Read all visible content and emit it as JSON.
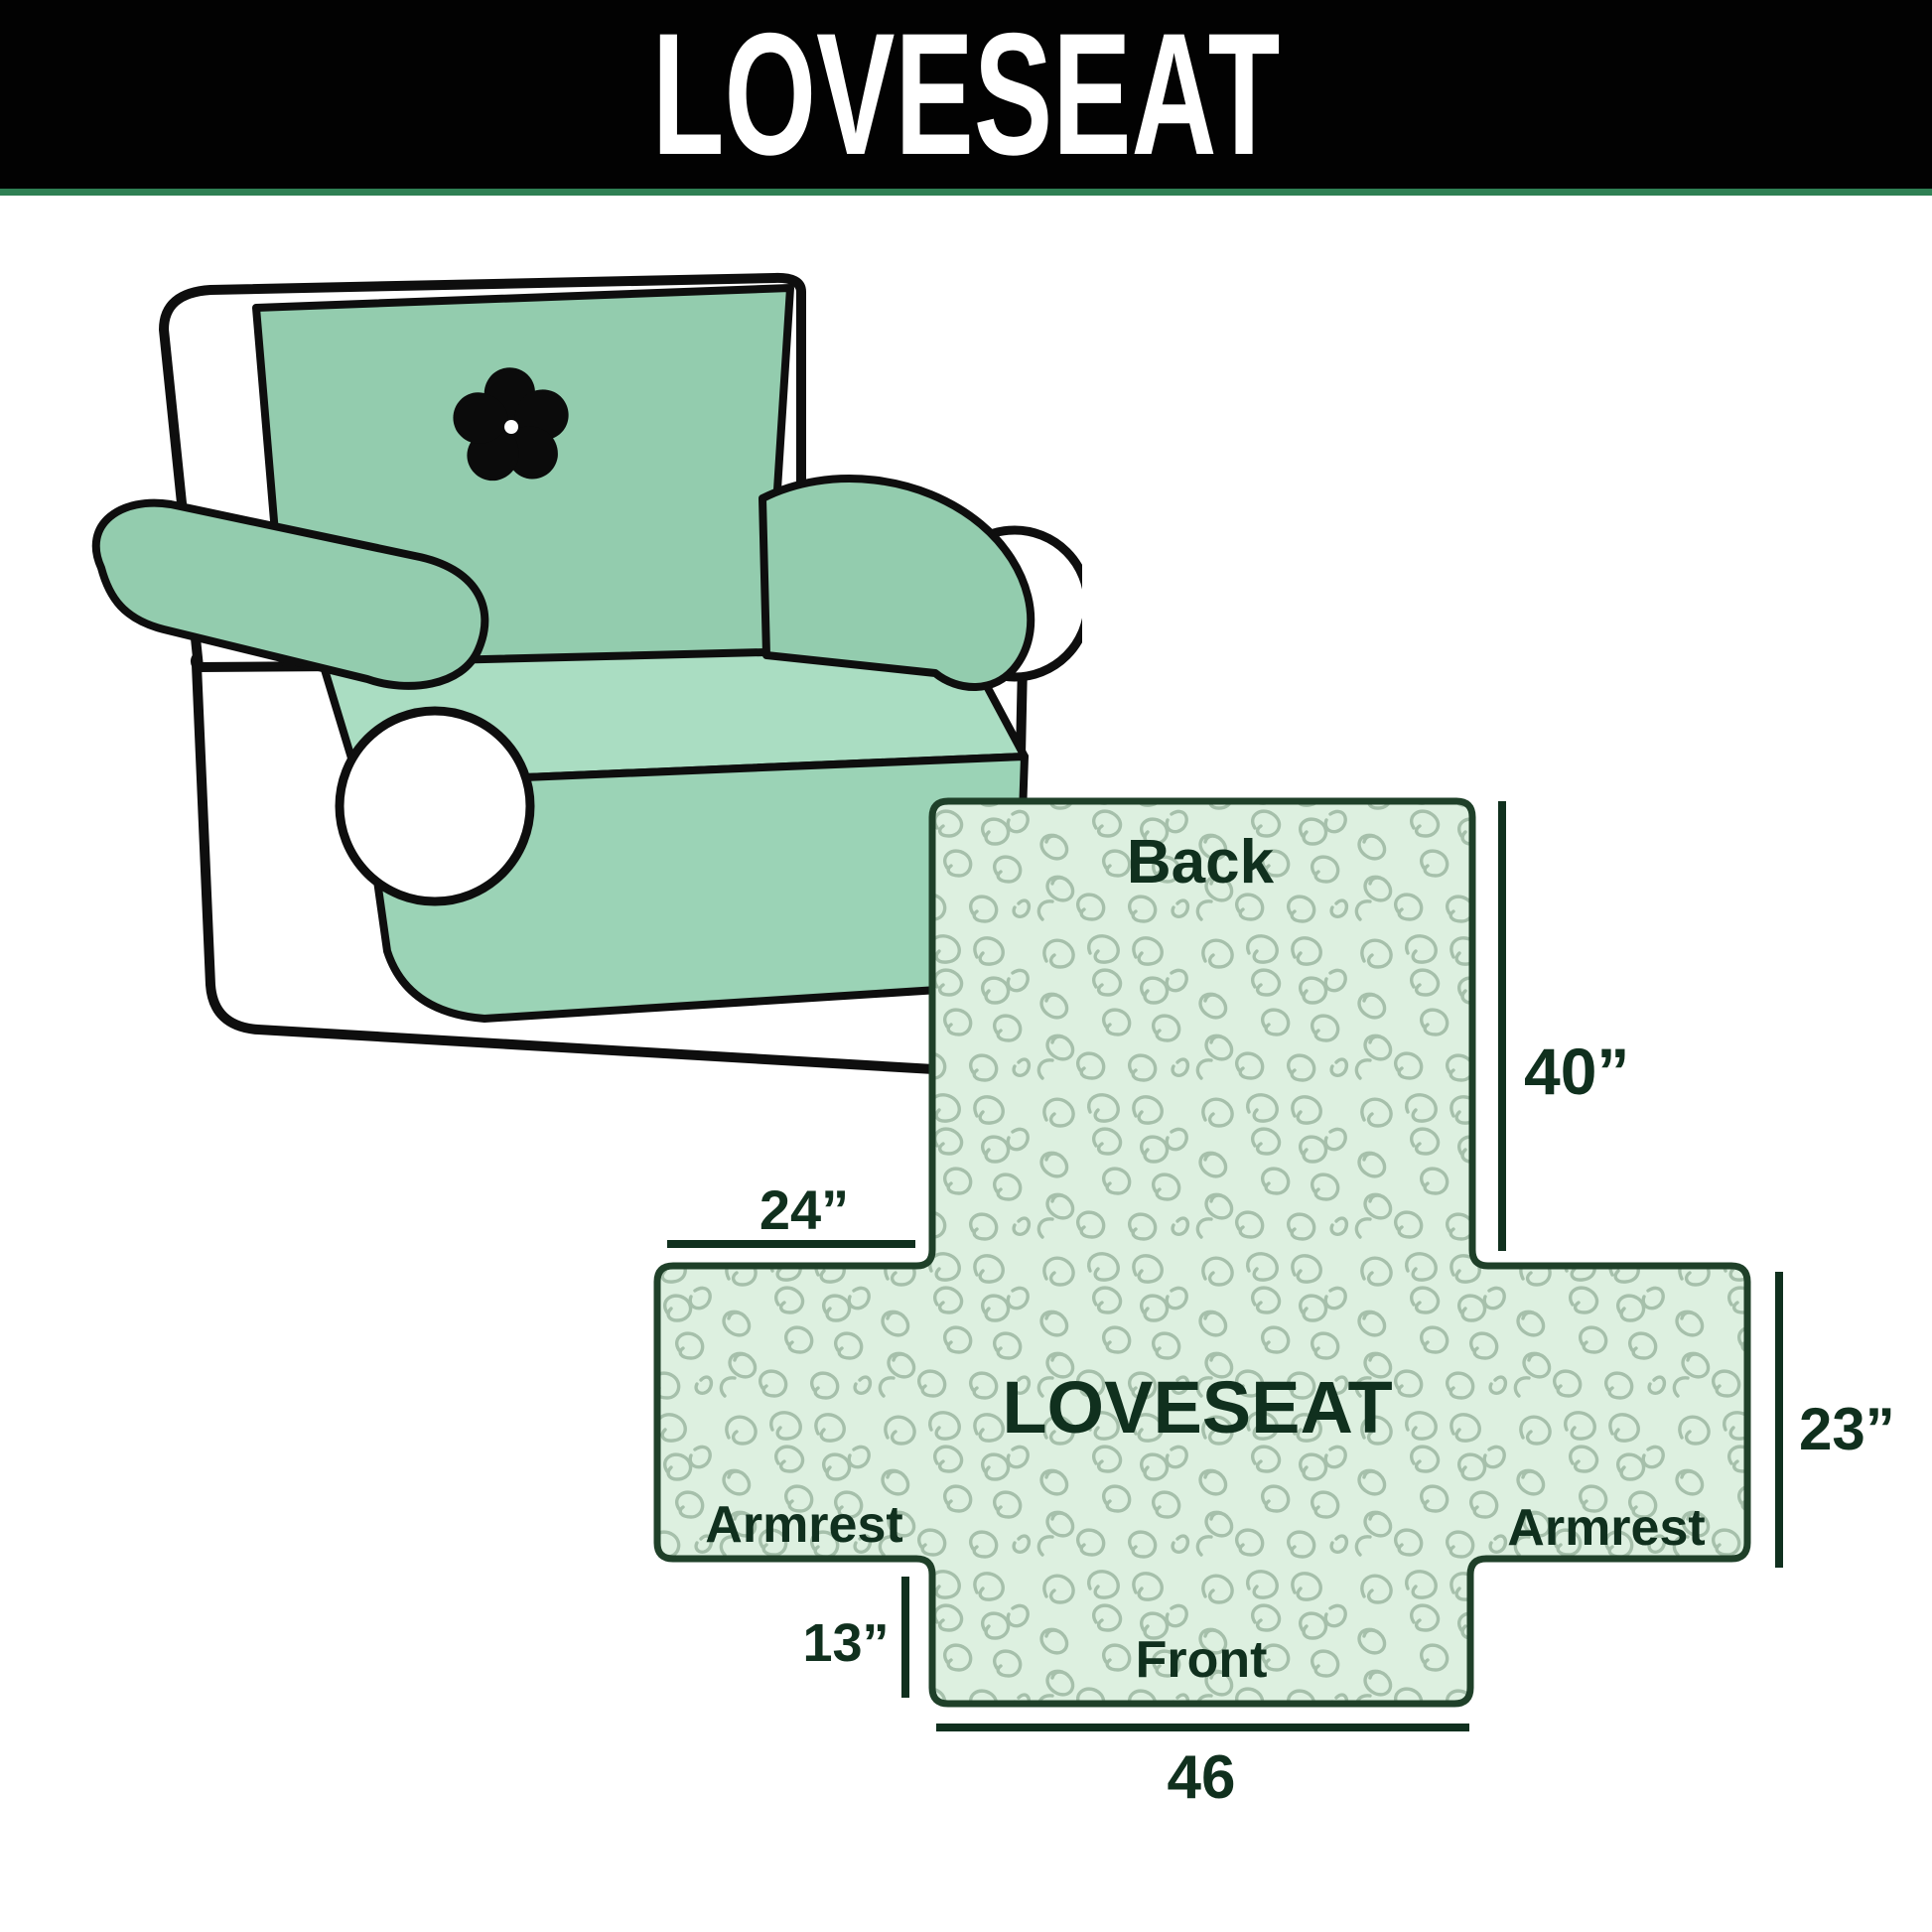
{
  "banner": {
    "title": "LOVESEAT",
    "bg_color": "#020202",
    "text_color": "#ffffff",
    "divider_color": "#2f8054"
  },
  "illustration": {
    "subject": "loveseat sofa with slipcover",
    "logo_icon": "pinwheel-icon",
    "cover_color": "#93ccae",
    "seat_color": "#aaddc2",
    "skirt_color": "#9bd3b6",
    "outline_color": "#0e0e0e"
  },
  "diagram": {
    "shape_fill": "#ddf0e0",
    "pattern_color": "#a6c0ab",
    "outline_color": "#1f4029",
    "annotation_color": "#10301e",
    "center_label": "LOVESEAT",
    "sections": {
      "back": "Back",
      "front": "Front",
      "armrest_left": "Armrest",
      "armrest_right": "Armrest"
    },
    "dimensions": {
      "back_height": "40”",
      "back_top_width": "24”",
      "armrest_height": "23”",
      "front_drop": "13”",
      "front_width": "46"
    }
  }
}
